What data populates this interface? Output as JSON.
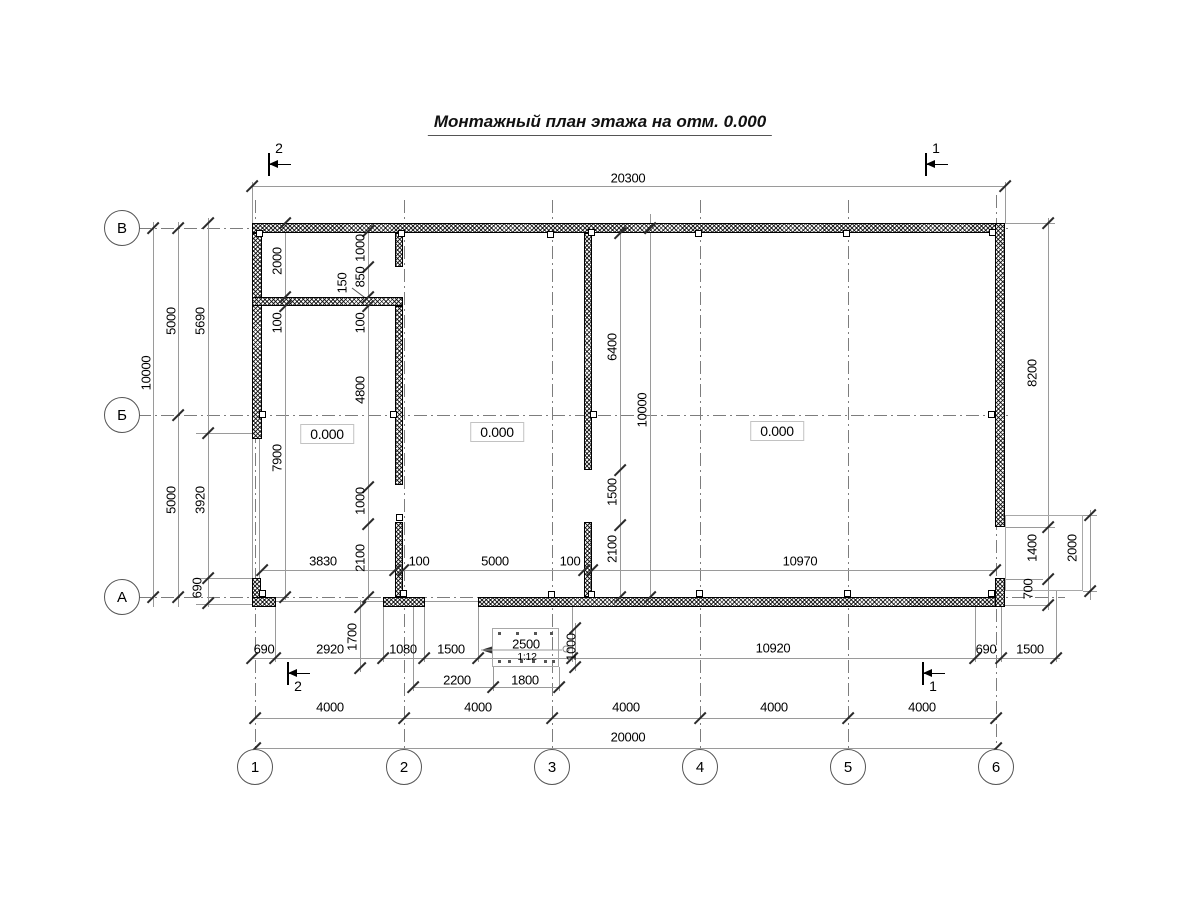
{
  "title": "Монтажный план этажа на отм. 0.000",
  "axes": {
    "rows": [
      {
        "label": "В",
        "x": 122,
        "y": 228
      },
      {
        "label": "Б",
        "x": 122,
        "y": 415
      },
      {
        "label": "А",
        "x": 122,
        "y": 597
      }
    ],
    "cols": [
      {
        "label": "1",
        "x": 255,
        "y": 767
      },
      {
        "label": "2",
        "x": 404,
        "y": 767
      },
      {
        "label": "3",
        "x": 552,
        "y": 767
      },
      {
        "label": "4",
        "x": 700,
        "y": 767
      },
      {
        "label": "5",
        "x": 848,
        "y": 767
      },
      {
        "label": "6",
        "x": 996,
        "y": 767
      }
    ]
  },
  "section_markers": [
    {
      "label": "2",
      "x": 268,
      "y": 164,
      "pos": "above"
    },
    {
      "label": "1",
      "x": 925,
      "y": 164,
      "pos": "above"
    },
    {
      "label": "2",
      "x": 287,
      "y": 673,
      "pos": "below"
    },
    {
      "label": "1",
      "x": 922,
      "y": 673,
      "pos": "below"
    }
  ],
  "elevation_marks": [
    {
      "text": "0.000",
      "x": 327,
      "y": 434
    },
    {
      "text": "0.000",
      "x": 497,
      "y": 432
    },
    {
      "text": "0.000",
      "x": 777,
      "y": 431
    }
  ],
  "ramp": {
    "length_label": "2500",
    "slope_label": "1:12"
  },
  "dimensions": [
    {
      "text": "20300",
      "x": 628,
      "y": 178,
      "v": false
    },
    {
      "text": "3830",
      "x": 323,
      "y": 561,
      "v": false
    },
    {
      "text": "100",
      "x": 419,
      "y": 561,
      "v": false
    },
    {
      "text": "5000",
      "x": 495,
      "y": 561,
      "v": false
    },
    {
      "text": "100",
      "x": 570,
      "y": 561,
      "v": false
    },
    {
      "text": "10970",
      "x": 800,
      "y": 561,
      "v": false
    },
    {
      "text": "690",
      "x": 264,
      "y": 649,
      "v": false
    },
    {
      "text": "2920",
      "x": 330,
      "y": 649,
      "v": false
    },
    {
      "text": "1080",
      "x": 403,
      "y": 649,
      "v": false
    },
    {
      "text": "1500",
      "x": 451,
      "y": 649,
      "v": false
    },
    {
      "text": "2500",
      "x": 526,
      "y": 644,
      "v": false
    },
    {
      "text": "1:12",
      "x": 527,
      "y": 657,
      "v": false,
      "small": true
    },
    {
      "text": "10920",
      "x": 773,
      "y": 648,
      "v": false
    },
    {
      "text": "690",
      "x": 986,
      "y": 649,
      "v": false
    },
    {
      "text": "1500",
      "x": 1030,
      "y": 649,
      "v": false
    },
    {
      "text": "2200",
      "x": 457,
      "y": 680,
      "v": false
    },
    {
      "text": "1800",
      "x": 525,
      "y": 680,
      "v": false
    },
    {
      "text": "4000",
      "x": 330,
      "y": 707,
      "v": false
    },
    {
      "text": "4000",
      "x": 478,
      "y": 707,
      "v": false
    },
    {
      "text": "4000",
      "x": 626,
      "y": 707,
      "v": false
    },
    {
      "text": "4000",
      "x": 774,
      "y": 707,
      "v": false
    },
    {
      "text": "4000",
      "x": 922,
      "y": 707,
      "v": false
    },
    {
      "text": "20000",
      "x": 628,
      "y": 737,
      "v": false
    },
    {
      "text": "10000",
      "x": 146,
      "y": 373,
      "v": true
    },
    {
      "text": "5000",
      "x": 171,
      "y": 321,
      "v": true
    },
    {
      "text": "5000",
      "x": 171,
      "y": 500,
      "v": true
    },
    {
      "text": "5690",
      "x": 200,
      "y": 321,
      "v": true
    },
    {
      "text": "3920",
      "x": 200,
      "y": 500,
      "v": true
    },
    {
      "text": "690",
      "x": 197,
      "y": 588,
      "v": true
    },
    {
      "text": "2000",
      "x": 277,
      "y": 261,
      "v": true
    },
    {
      "text": "100",
      "x": 277,
      "y": 323,
      "v": true
    },
    {
      "text": "7900",
      "x": 277,
      "y": 458,
      "v": true
    },
    {
      "text": "1000",
      "x": 360,
      "y": 248,
      "v": true
    },
    {
      "text": "850",
      "x": 360,
      "y": 277,
      "v": true
    },
    {
      "text": "150",
      "x": 342,
      "y": 283,
      "v": true
    },
    {
      "text": "100",
      "x": 360,
      "y": 323,
      "v": true
    },
    {
      "text": "4800",
      "x": 360,
      "y": 390,
      "v": true
    },
    {
      "text": "1000",
      "x": 360,
      "y": 501,
      "v": true
    },
    {
      "text": "2100",
      "x": 360,
      "y": 558,
      "v": true
    },
    {
      "text": "6400",
      "x": 612,
      "y": 347,
      "v": true
    },
    {
      "text": "1500",
      "x": 612,
      "y": 492,
      "v": true
    },
    {
      "text": "2100",
      "x": 612,
      "y": 549,
      "v": true
    },
    {
      "text": "10000",
      "x": 642,
      "y": 410,
      "v": true
    },
    {
      "text": "8200",
      "x": 1032,
      "y": 373,
      "v": true
    },
    {
      "text": "1400",
      "x": 1032,
      "y": 548,
      "v": true
    },
    {
      "text": "700",
      "x": 1028,
      "y": 589,
      "v": true
    },
    {
      "text": "2000",
      "x": 1072,
      "y": 548,
      "v": true
    },
    {
      "text": "1700",
      "x": 352,
      "y": 637,
      "v": true
    },
    {
      "text": "1000",
      "x": 571,
      "y": 647,
      "v": true
    }
  ]
}
